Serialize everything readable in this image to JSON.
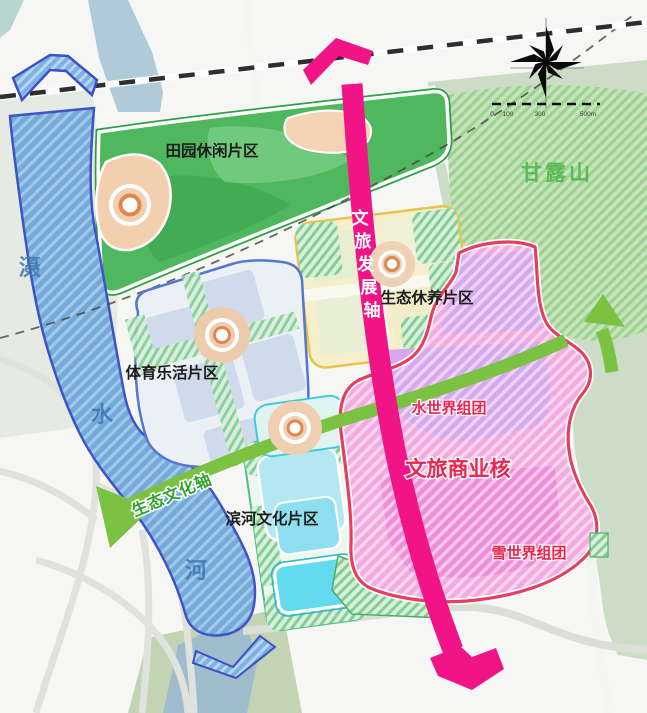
{
  "map": {
    "regions": {
      "pastoral": {
        "label": "田园休闲片区"
      },
      "ganlu_mountain": {
        "label": "甘露山"
      },
      "eco_recuperation": {
        "label": "生态休养片区"
      },
      "sports_lohas": {
        "label": "体育乐活片区"
      },
      "riverside_culture": {
        "label": "滨河文化片区"
      },
      "water_world": {
        "label": "水世界组团"
      },
      "cultural_commercial_core": {
        "label": "文旅商业核"
      },
      "snow_world": {
        "label": "雪世界组团"
      }
    },
    "axes": {
      "eco_culture": {
        "label": "生态文化轴",
        "color": "#7cc242"
      },
      "cultural_development": {
        "label": "文旅发展轴",
        "chars": [
          "文",
          "旅",
          "发",
          "展",
          "轴"
        ],
        "color": "#f01487"
      }
    },
    "river": {
      "name": "滠水河",
      "chars": [
        "滠",
        "水",
        "河"
      ]
    },
    "scalebar": {
      "labels": [
        "0",
        "100",
        "300",
        "500m"
      ]
    },
    "colors": {
      "core_label": "#e8274d",
      "mountain_label": "#54bb4f",
      "river_fill": "#74a9d8",
      "river_border": "#3e54c6",
      "core_border": "#e63e5f",
      "core_fill": "#f3aade"
    }
  }
}
